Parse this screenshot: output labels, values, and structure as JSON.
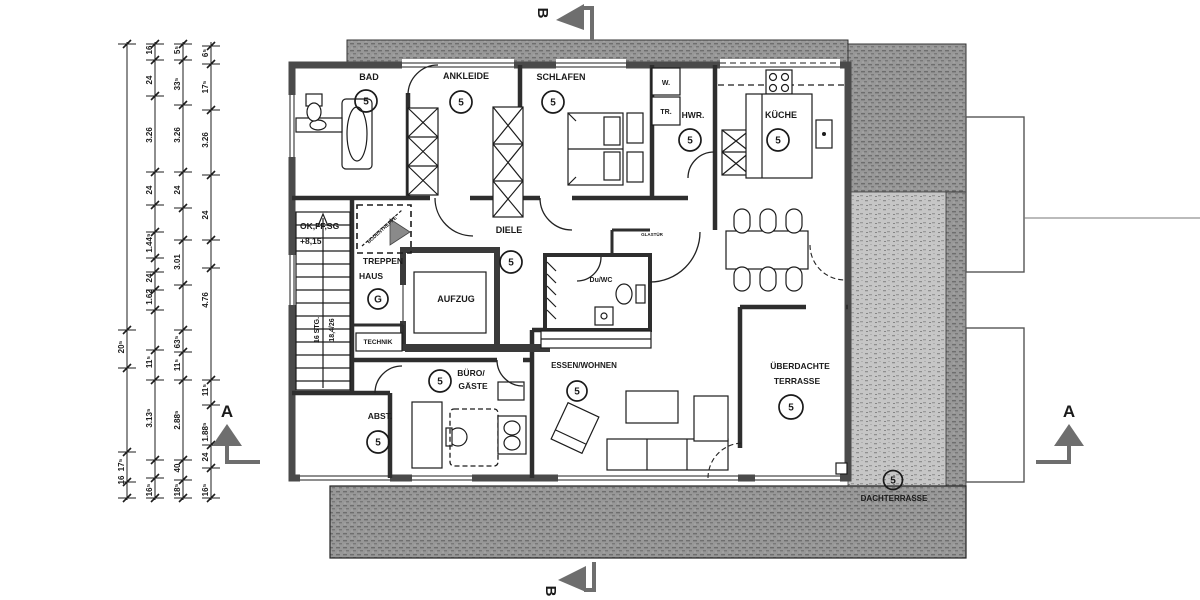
{
  "colors": {
    "wall_exterior": "#4a4a4a",
    "wall_interior": "#2e2e2e",
    "roof_hatch_dark": "#979797",
    "terrace_speckle": "#c3c3c3",
    "ink": "#1a1a1a",
    "paper": "#ffffff"
  },
  "markers": {
    "section_a_left": "A",
    "section_a_right": "A",
    "section_b_top": "B",
    "section_b_bottom": "B"
  },
  "labels": [
    {
      "id": "bad",
      "text": "BAD",
      "x": 369,
      "y": 80,
      "fs": 9,
      "badge": {
        "t": "5",
        "x": 366,
        "y": 101,
        "r": 11
      }
    },
    {
      "id": "ankleide",
      "text": "ANKLEIDE",
      "x": 466,
      "y": 79,
      "fs": 9,
      "badge": {
        "t": "5",
        "x": 461,
        "y": 102,
        "r": 11
      }
    },
    {
      "id": "schlafen",
      "text": "SCHLAFEN",
      "x": 561,
      "y": 80,
      "fs": 9,
      "badge": {
        "t": "5",
        "x": 553,
        "y": 102,
        "r": 11
      }
    },
    {
      "id": "hwr",
      "text": "HWR.",
      "x": 693,
      "y": 118,
      "fs": 8.5,
      "badge": {
        "t": "5",
        "x": 690,
        "y": 140,
        "r": 11
      }
    },
    {
      "id": "kueche",
      "text": "KÜCHE",
      "x": 781,
      "y": 118,
      "fs": 9,
      "badge": {
        "t": "5",
        "x": 778,
        "y": 140,
        "r": 11
      }
    },
    {
      "id": "washer",
      "text": "W.",
      "x": 666,
      "y": 85,
      "fs": 7
    },
    {
      "id": "dryer",
      "text": "TR.",
      "x": 666,
      "y": 114,
      "fs": 7
    },
    {
      "id": "diele",
      "text": "DIELE",
      "x": 509,
      "y": 233,
      "fs": 9,
      "badge": {
        "t": "5",
        "x": 511,
        "y": 262,
        "r": 11
      }
    },
    {
      "id": "duwc",
      "text": "Du/WC",
      "x": 601,
      "y": 282,
      "fs": 7
    },
    {
      "id": "treppenhaus",
      "text": "TREPPEN",
      "x": 383,
      "y": 264,
      "fs": 8.5,
      "text2": "HAUS",
      "x2": 371,
      "y2": 279,
      "badge": {
        "t": "G",
        "x": 378,
        "y": 299,
        "r": 10
      }
    },
    {
      "id": "aufzug",
      "text": "AUFZUG",
      "x": 456,
      "y": 302,
      "fs": 9
    },
    {
      "id": "technik",
      "text": "TECHNIK",
      "x": 378,
      "y": 344,
      "fs": 6.5
    },
    {
      "id": "buero",
      "text": "BÜRO/",
      "x": 471,
      "y": 376,
      "fs": 8.5,
      "text2": "GÄSTE",
      "x2": 473,
      "y2": 389,
      "badge": {
        "t": "5",
        "x": 440,
        "y": 381,
        "r": 11
      }
    },
    {
      "id": "abst",
      "text": "ABST.",
      "x": 380,
      "y": 419,
      "fs": 8.5,
      "badge": {
        "t": "5",
        "x": 378,
        "y": 442,
        "r": 11
      }
    },
    {
      "id": "essen-wohnen",
      "text": "ESSEN/WOHNEN",
      "x": 584,
      "y": 368,
      "fs": 8,
      "badge": {
        "t": "5",
        "x": 577,
        "y": 391,
        "r": 10
      }
    },
    {
      "id": "ueberdachte-terrasse",
      "text": "ÜBERDACHTE",
      "x": 800,
      "y": 369,
      "fs": 8.5,
      "text2": "TERRASSE",
      "x2": 797,
      "y2": 384,
      "badge": {
        "t": "5",
        "x": 791,
        "y": 407,
        "r": 12
      }
    },
    {
      "id": "dachterrasse",
      "text": "DACHTERRASSE",
      "x": 894,
      "y": 501,
      "fs": 8,
      "badge": {
        "t": "5",
        "x": 893,
        "y": 480,
        "r": 9.5
      }
    },
    {
      "id": "glastuer",
      "text": "GLASTÜR",
      "x": 652,
      "y": 236,
      "fs": 4.5
    },
    {
      "id": "level-note-1",
      "text": "OK,FF,SG",
      "x": 300,
      "y": 229,
      "fs": 8.5,
      "anchor": "start"
    },
    {
      "id": "level-note-2",
      "text": "+8,15",
      "x": 300,
      "y": 244,
      "fs": 8.5,
      "anchor": "start"
    },
    {
      "id": "stair-note-1",
      "text": "16 STG.",
      "x": 319,
      "y": 330,
      "fs": 7,
      "rot": -90
    },
    {
      "id": "stair-note-2",
      "text": "18,4/26",
      "x": 334,
      "y": 330,
      "fs": 7,
      "rot": -90
    },
    {
      "id": "attic-hatch",
      "text": "BODENTREPPE",
      "x": 383,
      "y": 231,
      "fs": 5,
      "rot": -42
    }
  ],
  "dimensions": {
    "columns_x": [
      127,
      155,
      183,
      211
    ],
    "entries": [
      {
        "v": "16",
        "c": 1,
        "y": 50
      },
      {
        "v": "5⁵",
        "c": 2,
        "y": 50
      },
      {
        "v": "6⁵",
        "c": 3,
        "y": 53
      },
      {
        "v": "24",
        "c": 1,
        "y": 80
      },
      {
        "v": "33⁵",
        "c": 2,
        "y": 84
      },
      {
        "v": "17⁵",
        "c": 3,
        "y": 87
      },
      {
        "v": "3.26",
        "c": 1,
        "y": 135
      },
      {
        "v": "3.26",
        "c": 2,
        "y": 135
      },
      {
        "v": "3.26",
        "c": 3,
        "y": 140
      },
      {
        "v": "24",
        "c": 1,
        "y": 190
      },
      {
        "v": "24",
        "c": 2,
        "y": 190
      },
      {
        "v": "24",
        "c": 3,
        "y": 215
      },
      {
        "v": "1.44⁵",
        "c": 1,
        "y": 243
      },
      {
        "v": "3.01",
        "c": 2,
        "y": 262
      },
      {
        "v": "24",
        "c": 1,
        "y": 278
      },
      {
        "v": "1.62",
        "c": 1,
        "y": 297
      },
      {
        "v": "4.76",
        "c": 3,
        "y": 300
      },
      {
        "v": "20⁵",
        "c": 0,
        "y": 347
      },
      {
        "v": "11⁵",
        "c": 1,
        "y": 362
      },
      {
        "v": "63⁵",
        "c": 2,
        "y": 342
      },
      {
        "v": "11⁵",
        "c": 2,
        "y": 365
      },
      {
        "v": "11⁵",
        "c": 3,
        "y": 390
      },
      {
        "v": "3.13⁵",
        "c": 1,
        "y": 418
      },
      {
        "v": "2.88⁵",
        "c": 2,
        "y": 420
      },
      {
        "v": "1.88⁵",
        "c": 3,
        "y": 432
      },
      {
        "v": "17⁵",
        "c": 0,
        "y": 465
      },
      {
        "v": "24",
        "c": 3,
        "y": 457
      },
      {
        "v": "40",
        "c": 2,
        "y": 468
      },
      {
        "v": "16",
        "c": 0,
        "y": 480
      },
      {
        "v": "16⁵",
        "c": 1,
        "y": 490
      },
      {
        "v": "18⁵",
        "c": 2,
        "y": 490
      },
      {
        "v": "16⁵",
        "c": 3,
        "y": 490
      }
    ]
  }
}
